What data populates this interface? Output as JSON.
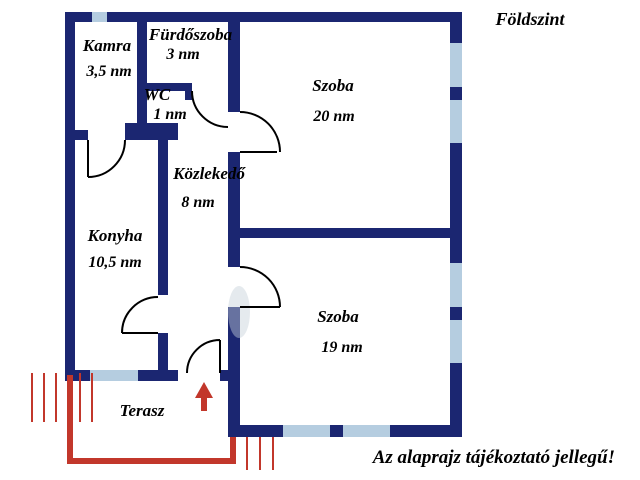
{
  "title": "Földszint",
  "disclaimer": "Az alaprajz tájékoztató jellegű!",
  "rooms": [
    {
      "name": "Kamra",
      "area": "3,5 nm"
    },
    {
      "name": "Fürdőszoba",
      "area": "3 nm"
    },
    {
      "name": "WC",
      "area": "1 nm"
    },
    {
      "name": "Szoba",
      "area": "20 nm"
    },
    {
      "name": "Közlekedő",
      "area": "8 nm"
    },
    {
      "name": "Konyha",
      "area": "10,5 nm"
    },
    {
      "name": "Szoba",
      "area": "19 nm"
    },
    {
      "name": "Terasz",
      "area": ""
    }
  ],
  "icons": {
    "entrance_arrow": "up-arrow-icon"
  },
  "colors": {
    "wall": "#1b2671",
    "window": "#b5cde0",
    "accent_red": "#c2372b",
    "text": "#000000"
  }
}
